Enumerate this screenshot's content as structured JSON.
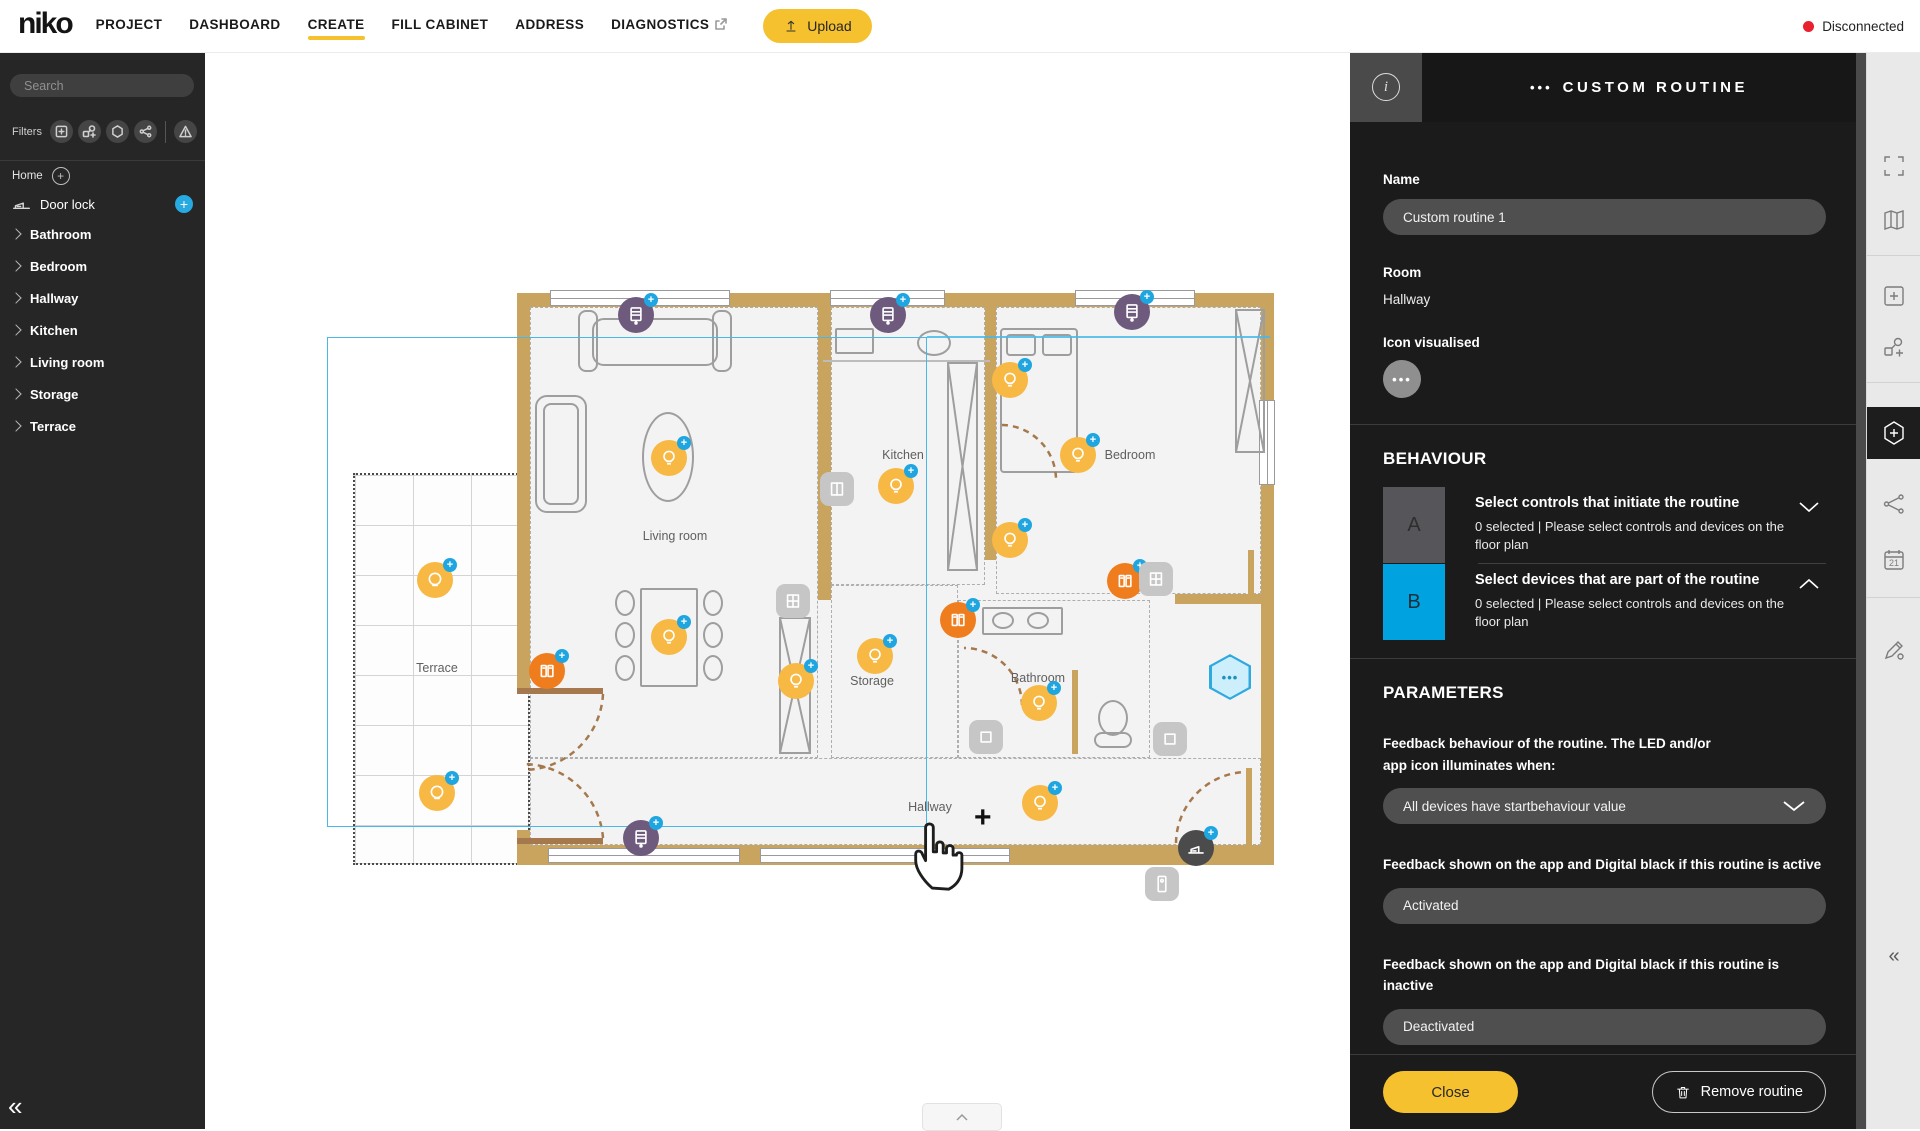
{
  "topbar": {
    "logo": "niko",
    "nav": [
      "PROJECT",
      "DASHBOARD",
      "CREATE",
      "FILL CABINET",
      "ADDRESS",
      "DIAGNOSTICS"
    ],
    "active": "CREATE",
    "upload": "Upload",
    "status": "Disconnected"
  },
  "sidebar": {
    "search_placeholder": "Search",
    "filters_label": "Filters",
    "filter_icons": [
      "square-plus-icon",
      "link-plus-icon",
      "hexagon-icon",
      "share-icon",
      "warning-icon"
    ],
    "home_label": "Home",
    "device_label": "Door lock",
    "rooms": [
      "Bathroom",
      "Bedroom",
      "Hallway",
      "Kitchen",
      "Living room",
      "Storage",
      "Terrace"
    ],
    "collapse": "«"
  },
  "floorplan": {
    "labels": [
      {
        "text": "Living room",
        "x": 675,
        "y": 536
      },
      {
        "text": "Kitchen",
        "x": 903,
        "y": 455
      },
      {
        "text": "Bedroom",
        "x": 1130,
        "y": 455
      },
      {
        "text": "Terrace",
        "x": 437,
        "y": 668
      },
      {
        "text": "Storage",
        "x": 872,
        "y": 681
      },
      {
        "text": "Bathroom",
        "x": 1038,
        "y": 678
      },
      {
        "text": "Hallway",
        "x": 930,
        "y": 807
      }
    ],
    "devices": [
      {
        "type": "blind",
        "name": "motor-blind",
        "x": 636,
        "y": 315
      },
      {
        "type": "blind",
        "name": "motor-blind",
        "x": 888,
        "y": 315
      },
      {
        "type": "blind",
        "name": "motor-blind",
        "x": 1132,
        "y": 312
      },
      {
        "type": "blind",
        "name": "motor-blind",
        "x": 641,
        "y": 838
      },
      {
        "type": "light",
        "name": "light",
        "x": 669,
        "y": 458
      },
      {
        "type": "light",
        "name": "light",
        "x": 896,
        "y": 486
      },
      {
        "type": "light",
        "name": "light",
        "x": 669,
        "y": 637
      },
      {
        "type": "light",
        "name": "light",
        "x": 796,
        "y": 681
      },
      {
        "type": "light",
        "name": "light",
        "x": 875,
        "y": 656
      },
      {
        "type": "light",
        "name": "light",
        "x": 1010,
        "y": 380
      },
      {
        "type": "light",
        "name": "light",
        "x": 1010,
        "y": 540
      },
      {
        "type": "light",
        "name": "light",
        "x": 1078,
        "y": 455
      },
      {
        "type": "light",
        "name": "light",
        "x": 1039,
        "y": 703
      },
      {
        "type": "light",
        "name": "light",
        "x": 1040,
        "y": 803
      },
      {
        "type": "light_o",
        "name": "outdoor-light",
        "x": 435,
        "y": 580
      },
      {
        "type": "light_o",
        "name": "outdoor-light",
        "x": 437,
        "y": 793
      },
      {
        "type": "heater",
        "name": "heating",
        "x": 547,
        "y": 671
      },
      {
        "type": "heater",
        "name": "heating",
        "x": 958,
        "y": 620
      },
      {
        "type": "heater",
        "name": "heating",
        "x": 1125,
        "y": 581
      },
      {
        "type": "sock2",
        "name": "wall-control",
        "x": 838,
        "y": 490
      },
      {
        "type": "sock4",
        "name": "wall-control",
        "x": 1157,
        "y": 580
      },
      {
        "type": "sock4",
        "name": "wall-control",
        "x": 794,
        "y": 602
      },
      {
        "type": "sock",
        "name": "wall-control",
        "x": 987,
        "y": 738
      },
      {
        "type": "sock",
        "name": "wall-control",
        "x": 1171,
        "y": 740
      },
      {
        "type": "bell",
        "name": "doorbell",
        "x": 1163,
        "y": 885
      },
      {
        "type": "lock",
        "name": "door-lock",
        "x": 1196,
        "y": 848
      },
      {
        "type": "hex",
        "name": "routine-hexagon",
        "x": 1230,
        "y": 675
      }
    ]
  },
  "panel": {
    "title": "CUSTOM ROUTINE",
    "title_dots": "•••",
    "name_label": "Name",
    "name_value": "Custom routine 1",
    "room_label": "Room",
    "room_value": "Hallway",
    "icon_label": "Icon visualised",
    "icon_glyph": "•••",
    "behaviour": {
      "heading": "BEHAVIOUR",
      "rows": [
        {
          "key": "A",
          "title": "Select controls that initiate the routine",
          "desc": "0 selected | Please select controls and devices on the floor plan"
        },
        {
          "key": "B",
          "title": "Select devices that are part of the routine",
          "desc": "0 selected | Please select controls and devices on the floor plan"
        }
      ]
    },
    "parameters": {
      "heading": "PARAMETERS",
      "feedback_label": "Feedback behaviour of the routine. The LED and/or app icon illuminates when:",
      "feedback_value": "All devices have startbehaviour value",
      "active_label": "Feedback shown on the app and Digital black if this routine is active",
      "active_value": "Activated",
      "inactive_label": "Feedback shown on the app and Digital black if this routine is inactive",
      "inactive_value": "Deactivated"
    },
    "close": "Close",
    "remove": "Remove routine"
  },
  "toolbar": {
    "calendar_day": "21",
    "collapse": "«"
  },
  "colors": {
    "accent_yellow": "#f5c12e",
    "accent_blue": "#00a3e0",
    "badge_blue": "#1fa6e0",
    "device_yellow": "#f7b844",
    "device_orange": "#ef7d1e",
    "device_purple": "#6d5a7d",
    "status_red": "#e8212e",
    "wall_tan": "#c8a45e",
    "selection_cyan": "#46b8e9"
  }
}
